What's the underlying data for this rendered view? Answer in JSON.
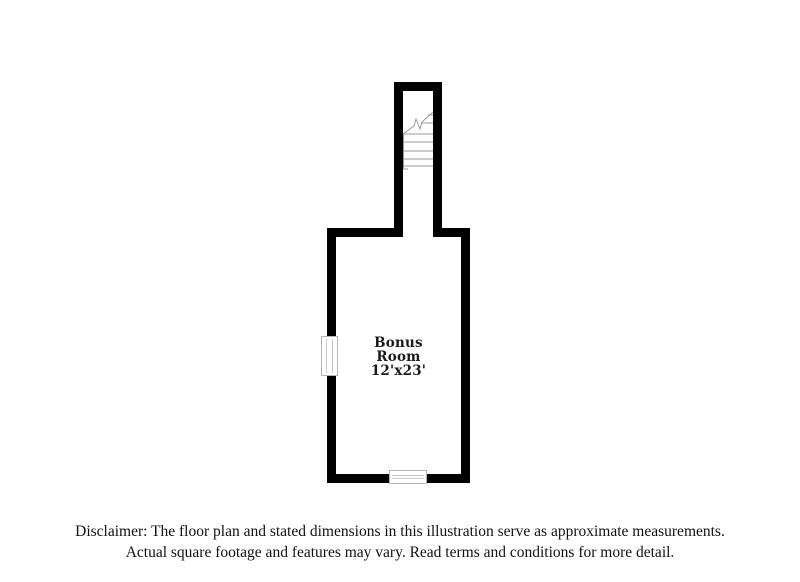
{
  "page": {
    "background_color": "#ffffff"
  },
  "floorplan": {
    "room_label": {
      "line1": "Bonus",
      "line2": "Room",
      "dimensions": "12'x23'"
    },
    "icons": {
      "staircase": "stairs-icon",
      "left_window": "window-icon",
      "bottom_window": "window-icon"
    },
    "colors": {
      "wall": "#000000",
      "stair_lines": "#9a9a9a",
      "window_outline": "#b5b5b5",
      "label_text": "#1a1a1a"
    }
  },
  "disclaimer": {
    "line1": "Disclaimer: The floor plan and stated dimensions in this illustration serve as approximate measurements.",
    "line2": "Actual square footage and features may vary. Read terms and conditions for more detail."
  }
}
